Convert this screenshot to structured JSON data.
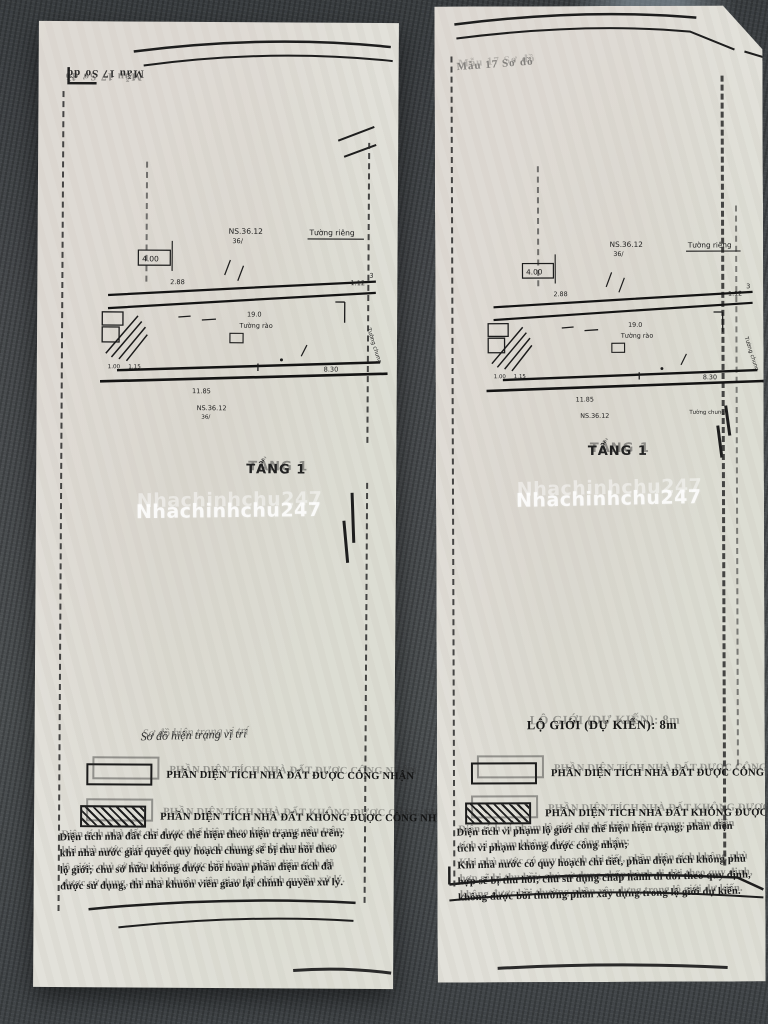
{
  "watermark": {
    "text": "Nhachinhchu247"
  },
  "plan_labels": {
    "parcel": "NS.36.12",
    "parcel_sub": "36/",
    "wall_own": "Tường riêng",
    "wall_fence": "Tường rào",
    "wall_shared": "Tường chung",
    "dims": {
      "d400": "4.00",
      "d288": "2.88",
      "d3": "3",
      "d190": "19.0",
      "d112": "1.12",
      "d830": "8.30",
      "d1185": "11.85",
      "d100": "1.00",
      "d115": "1.15"
    }
  },
  "pages": {
    "left": {
      "corner_label": "Mẫu 17 Sơ đồ",
      "floor_label": "TẦNG 1",
      "section_title": "Sơ đồ hiện trạng vị trí",
      "legend": [
        {
          "label": "PHẦN DIỆN TÍCH NHÀ ĐẤT ĐƯỢC CÔNG NHẬN"
        },
        {
          "label": "PHẦN DIỆN TÍCH NHÀ ĐẤT KHÔNG ĐƯỢC CÔNG NHẬN"
        }
      ],
      "notes": [
        "Diện tích nhà đất chỉ được thể hiện theo hiện trạng nêu trên;",
        "khi nhà nước giải quyết quy hoạch chung sẽ bị thu hồi theo",
        "lộ giới; chủ sở hữu không được bồi hoàn phần diện tích đã",
        "được sử dụng, thì nhà khuôn viên giao lại chính quyền xử lý."
      ]
    },
    "right": {
      "corner_label": "Mẫu 17 Sơ đồ",
      "floor_label": "TẦNG 1",
      "section_title": "LỘ GIỚI (DỰ KIẾN): 8m",
      "legend": [
        {
          "label": "PHẦN DIỆN TÍCH NHÀ ĐẤT ĐƯỢC CÔNG NHẬN"
        },
        {
          "label": "PHẦN DIỆN TÍCH NHÀ ĐẤT KHÔNG ĐƯỢC CÔNG NHẬN"
        }
      ],
      "notes": [
        "Diện tích vi phạm lộ giới chỉ thể hiện hiện trạng; phần diện",
        "tích vi phạm không được công nhận;",
        "Khi nhà nước có quy hoạch chi tiết, phần diện tích không phù",
        "hợp sẽ bị thu hồi; chủ sử dụng chấp hành di dời theo quy định,",
        "không được bồi thường phần xây dựng trong lộ giới dự kiến."
      ]
    }
  }
}
